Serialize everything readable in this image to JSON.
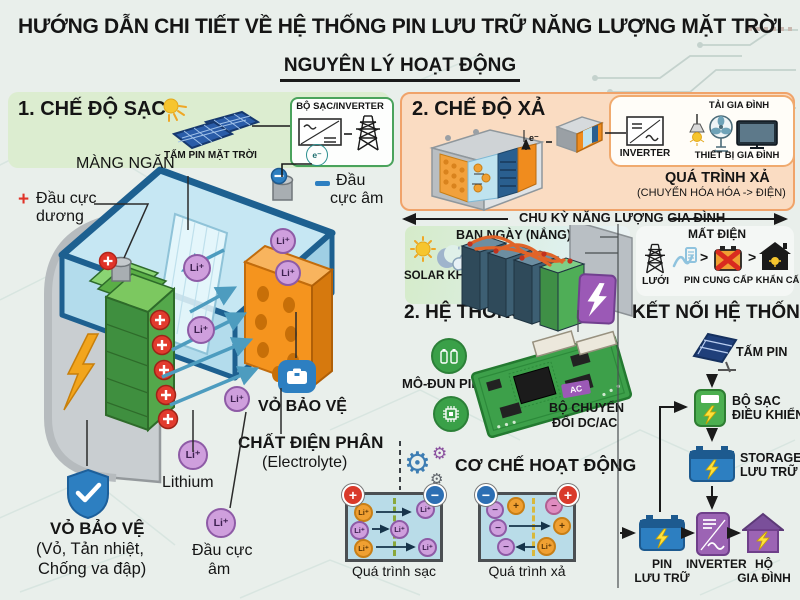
{
  "header": {
    "title": "HƯỚNG DẪN CHI TIẾT VỀ HỆ THỐNG PIN LƯU TRỮ NĂNG LƯỢNG MẶT TRỜI",
    "subtitle": "NGUYÊN LÝ HOẠT ĐỘNG"
  },
  "charge_section": {
    "heading": "1. CHẾ ĐỘ SẠC",
    "panel_label": "TẤM PIN MẶT TRỜI",
    "charger_label": "BỘ SẠC/INVERTER",
    "electron": "e⁻",
    "neg_line1": "Đầu",
    "neg_line2": "cực âm"
  },
  "battery": {
    "membrane": "MÀNG NGĂN",
    "pos_sign": "+",
    "pos_line1": "Đầu cực",
    "pos_line2": "dương",
    "case_label": "VỎ BẢO VỆ",
    "electrolyte1": "CHẤT ĐIỆN PHÂN",
    "electrolyte2": "(Electrolyte)",
    "shield_label": "VỎ BẢO VỆ",
    "shield_sub1": "(Vỏ, Tản nhiệt,",
    "shield_sub2": "Chống va đập)",
    "li": "Li⁺",
    "lithium": "Lithium",
    "neg2_line1": "Đầu cực",
    "neg2_line2": "âm"
  },
  "discharge_section": {
    "heading": "2. CHẾ ĐỘ XẢ",
    "electron": "e⁻",
    "inverter": "INVERTER",
    "load": "TẢI GIA ĐÌNH",
    "devices": "THIẾT BỊ GIA ĐÌNH",
    "process": "QUÁ TRÌNH XẢ",
    "process_sub": "(CHUYỂN HÓA HÓA -> ĐIỆN)"
  },
  "cycle": {
    "label": "CHU KỲ NĂNG LƯỢNG GIA ĐÌNH"
  },
  "day": {
    "label": "BAN NGÀY (NẮNG)",
    "solar": "SOLAR KHÔNG/ÍT"
  },
  "outage": {
    "label": "MẤT ĐIỆN",
    "grid": "LƯỚI",
    "backup": "PIN CUNG CẤP KHẨN CẤP"
  },
  "bms": {
    "heading": "2. HỆ THỐNG QUẢ",
    "module": "MÔ-ĐUN PIN",
    "converter1": "BỘ CHUYỂN",
    "converter2": "ĐỔI DC/AC",
    "ac": "AC"
  },
  "connection": {
    "heading": "KẾT NỐI HỆ THỐNG",
    "panel": "TẤM PIN",
    "controller1": "BỘ SẠC",
    "controller2": "ĐIỀU KHIỂN",
    "storage1": "STORAGE",
    "storage2": "LƯU TRỮ",
    "battery1": "PIN",
    "battery2": "LƯU TRỮ",
    "inverter": "INVERTER",
    "home1": "HỘ",
    "home2": "GIA ĐÌNH"
  },
  "mechanism": {
    "heading": "CƠ CHẾ HOẠT ĐỘNG",
    "charge": "Quá trình sạc",
    "discharge": "Quá trình xả",
    "plus": "+",
    "minus": "−",
    "li": "Li⁺"
  },
  "colors": {
    "accent_green": "#3aa048",
    "accent_orange": "#f5941e",
    "accent_blue": "#2d7fc1",
    "accent_purple": "#9b59b6",
    "negative_red": "#e03328"
  }
}
